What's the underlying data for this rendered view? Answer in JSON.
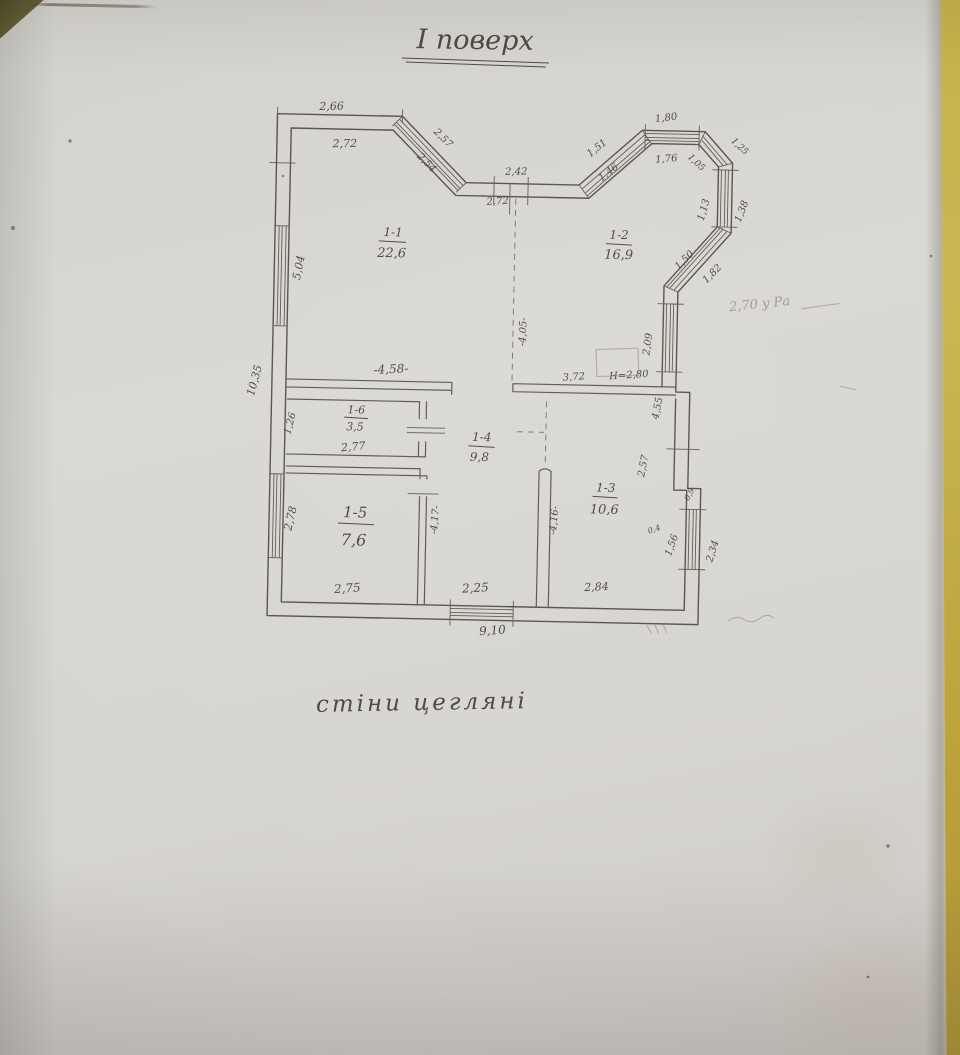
{
  "document": {
    "title": "І поверх",
    "note": "стіни цегляні",
    "pencil_note": "2,70 у Ра"
  },
  "rooms": [
    {
      "id": "1-1",
      "area": "22,6"
    },
    {
      "id": "1-2",
      "area": "16,9"
    },
    {
      "id": "1-3",
      "area": "10,6"
    },
    {
      "id": "1-4",
      "area": "9,8"
    },
    {
      "id": "1-5",
      "area": "7,6"
    },
    {
      "id": "1-6",
      "area": "3,5"
    }
  ],
  "dims": {
    "top_266": "2,66",
    "top_272": "2,72",
    "diag_257": "2,57",
    "diag_254": "2,54",
    "entry_242": "2,42",
    "entry_272": "2,72",
    "diag_151": "1,51",
    "diag_146": "1,46",
    "win_180": "1,80",
    "win_176": "1,76",
    "diag_125": "1,25",
    "diag_105": "1,05",
    "win_113": "1,13",
    "win_138": "1,38",
    "diag_150": "1,50",
    "diag_182": "1,82",
    "win_209": "2,09",
    "left_504": "5,04",
    "left_1035": "10,35",
    "left_126": "1,26",
    "left_278": "2,78",
    "hall_458": "-4,58-",
    "hall_405": "-4,05-",
    "hall_372": "3,72",
    "height_280": "Н=2,80",
    "right_455": "4,55",
    "right_257": "2,57",
    "step_09": "0,9",
    "step_04": "0,4",
    "win_156": "1,56",
    "win_234": "2,34",
    "r16_277": "2,77",
    "r15_275": "2,75",
    "r14_225": "2,25",
    "r13_284": "2,84",
    "corr_417": "-4,17-",
    "corr_416": "-4,16-",
    "bottom_910": "9,10"
  }
}
